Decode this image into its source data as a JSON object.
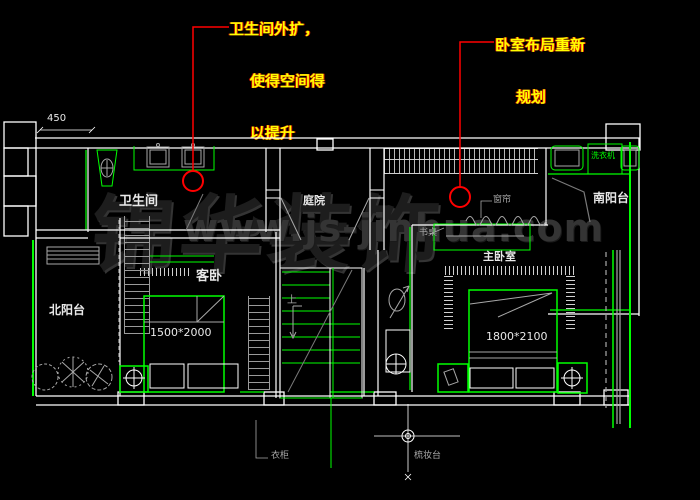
{
  "annotations": {
    "bathroom_note": {
      "line1": "卫生间外扩，",
      "line2": "使得空间得",
      "line3": "以提升"
    },
    "bedroom_note": {
      "line1": "卧室布局重新",
      "line2": "规划"
    }
  },
  "room_labels": {
    "bathroom": "卫生间",
    "courtyard": "庭院",
    "south_balcony": "南阳台",
    "north_balcony": "北阳台",
    "guest_bedroom": "客卧",
    "master_bedroom": "主卧室"
  },
  "fixture_labels": {
    "washing_machine": "洗衣机",
    "desk": "书桌",
    "curtain": "窗帘",
    "wardrobe": "衣柜",
    "dressing_table": "梳妆台",
    "stairs_up": "上"
  },
  "dimensions": {
    "guest_bed": "1500*2000",
    "master_bed": "1800*2100",
    "offset": "450"
  },
  "watermark": {
    "brand": "锦华装饰",
    "site": "www.js-jinhua.com"
  },
  "colors": {
    "background": "#000000",
    "wall": "#ffffff",
    "fixture_green": "#00ff00",
    "detail_gray": "#a8a8a8",
    "annotation_text": "#ffff00",
    "leader_red": "#ff0000",
    "watermark": "#1d1d1d"
  }
}
